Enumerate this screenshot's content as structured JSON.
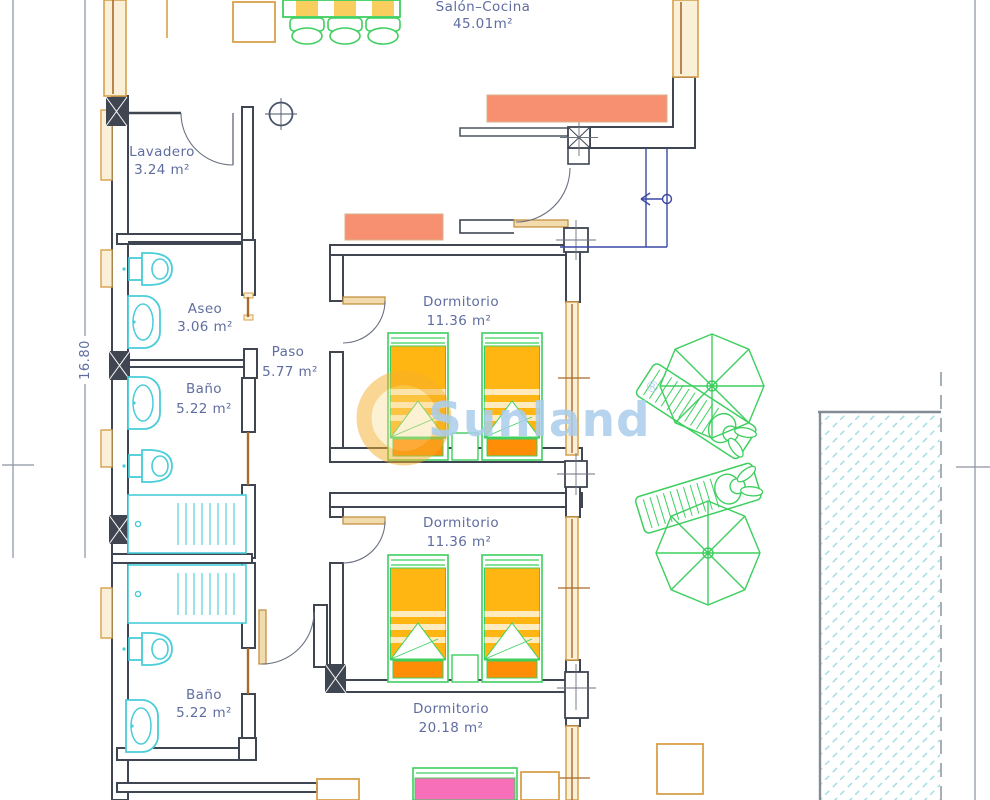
{
  "rooms": {
    "salon": {
      "name": "Salón–Cocina",
      "area": "45.01m²"
    },
    "lavadero": {
      "name": "Lavadero",
      "area": "3.24 m²"
    },
    "aseo": {
      "name": "Aseo",
      "area": "3.06 m²"
    },
    "paso": {
      "name": "Paso",
      "area": "5.77 m²"
    },
    "banio1": {
      "name": "Baño",
      "area": "5.22 m²"
    },
    "dormitorio1": {
      "name": "Dormitorio",
      "area": "11.36 m²"
    },
    "dormitorio2": {
      "name": "Dormitorio",
      "area": "11.36 m²"
    },
    "banio2": {
      "name": "Baño",
      "area": "5.22 m²"
    },
    "dormitorio3": {
      "name": "Dormitorio",
      "area": "20.18 m²"
    }
  },
  "dimensions": {
    "left_height": "16.80"
  },
  "watermark": {
    "brand": "Sunland",
    "registered": "®"
  },
  "colors": {
    "wall": "#3f4652",
    "label_text": "#5f6da0",
    "window_tan": "#d8a04b",
    "window_brown": "#a96a2c",
    "salmon_furniture": "#f79071",
    "bed_yellow": "#ffb612",
    "pillow_orange": "#ff8d05",
    "double_bed_pink": "#f76fb8",
    "fixture_cyan": "#48cdd9",
    "outdoor_green": "#3ecf5f",
    "pool_hatch": "#a7e0e5",
    "entry_navy": "#3a49a5",
    "watermark_blue": "#aacdec",
    "watermark_sun": "#f6ae2b"
  }
}
